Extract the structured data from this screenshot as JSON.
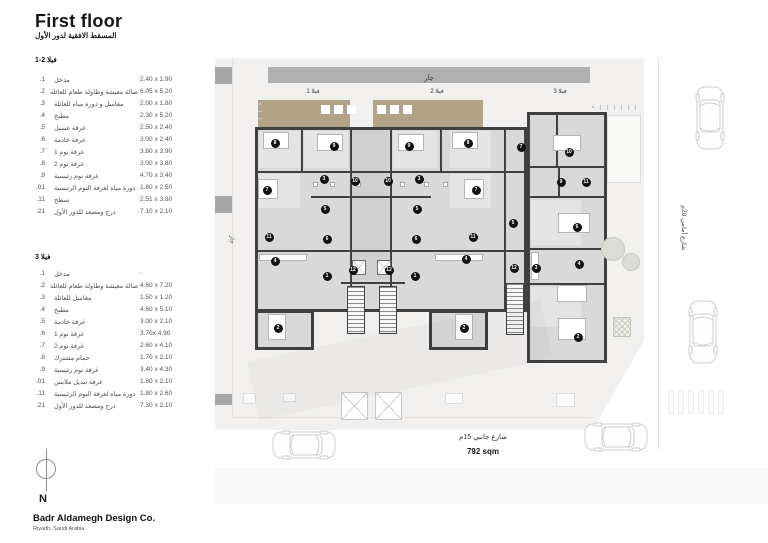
{
  "header": {
    "title": "First floor",
    "subtitle_ar": "المسقط الافقية لدور الأول"
  },
  "legends": [
    {
      "heading": "فيلا 2-1",
      "rows": [
        {
          "no": ".1",
          "name": "مدخل",
          "dim": "2.40 x 1.90"
        },
        {
          "no": ".2",
          "name": "صالة معيشة وطاولة طعام للعائلة",
          "dim": "6.05 x 5.20"
        },
        {
          "no": ".3",
          "name": "مغاسل و دورة مياه للعائلة",
          "dim": "2.00 x 1.80"
        },
        {
          "no": ".4",
          "name": "مطبخ",
          "dim": "2.30 x 5.20"
        },
        {
          "no": ".5",
          "name": "غرفة غسيل",
          "dim": "2.50 x 2.40"
        },
        {
          "no": ".6",
          "name": "غرفة خادمة",
          "dim": "3.00 x 2.40"
        },
        {
          "no": ".7",
          "name": "غرفة نوم 1",
          "dim": "3.80 x 3.90"
        },
        {
          "no": ".8",
          "name": "غرفة نوم 2",
          "dim": "3.00 x 3.80"
        },
        {
          "no": ".9",
          "name": "غرفة نوم رئيسية",
          "dim": "4.70 x 3.40"
        },
        {
          "no": ".01",
          "name": "دورة مياه لغرفة النوم الرئيسية",
          "dim": "1.80 x 2.50"
        },
        {
          "no": ".11",
          "name": "سطح",
          "dim": "2.51 x 3.80"
        },
        {
          "no": ".21",
          "name": "درج ومصعد للدور الأول",
          "dim": "7.10 x 2.10"
        }
      ]
    },
    {
      "heading": "فيلا 3",
      "rows": [
        {
          "no": ".1",
          "name": "مدخل",
          "dim": "-"
        },
        {
          "no": ".2",
          "name": "صالة معيشة وطاولة طعام للعائلة",
          "dim": "4.60 x 7.20"
        },
        {
          "no": ".3",
          "name": "مغاسل للعائلة",
          "dim": "1.50 x 1.20"
        },
        {
          "no": ".4",
          "name": "مطبخ",
          "dim": "4.60 x 5.10"
        },
        {
          "no": ".5",
          "name": "غرفة خادمة",
          "dim": "3.00 x 2.10"
        },
        {
          "no": ".6",
          "name": "غرفة نوم 1",
          "dim": "3.70x 4.90"
        },
        {
          "no": ".7",
          "name": "غرفة نوم 2",
          "dim": "2.60 x 4.10"
        },
        {
          "no": ".8",
          "name": "حمام مشترك",
          "dim": "1.70 x 2.10"
        },
        {
          "no": ".9",
          "name": "غرفة نوم رئيسية",
          "dim": "3.40 x 4.30"
        },
        {
          "no": ".01",
          "name": "غرفة تبديل ملابس",
          "dim": "1.80 x 2.10"
        },
        {
          "no": ".11",
          "name": "دورة مياه لغرفة النوم الرئيسية",
          "dim": "1.80 x 2.60"
        },
        {
          "no": ".21",
          "name": "درج ومصعد للدور الأول",
          "dim": "7.30 x 2.10"
        }
      ]
    }
  ],
  "plan": {
    "neighbor_top": "جار",
    "neighbor_left": "جار",
    "villas": [
      "فيلا 1",
      "فيلا 2",
      "فيلا 3"
    ],
    "street_side": "شارع جانبي 15م",
    "street_front": "شارع أمامي 20م",
    "area_label": "792 sqm",
    "badges": {
      "villa1": [
        {
          "n": "8",
          "x": 275,
          "y": 143
        },
        {
          "n": "9",
          "x": 334,
          "y": 146
        },
        {
          "n": "3",
          "x": 324,
          "y": 179
        },
        {
          "n": "10",
          "x": 355,
          "y": 181
        },
        {
          "n": "7",
          "x": 267,
          "y": 190
        },
        {
          "n": "5",
          "x": 325,
          "y": 209
        },
        {
          "n": "11",
          "x": 269,
          "y": 237
        },
        {
          "n": "6",
          "x": 327,
          "y": 239
        },
        {
          "n": "4",
          "x": 275,
          "y": 261
        },
        {
          "n": "12",
          "x": 353,
          "y": 270
        },
        {
          "n": "1",
          "x": 327,
          "y": 276
        },
        {
          "n": "2",
          "x": 278,
          "y": 328
        }
      ],
      "villa2": [
        {
          "n": "9",
          "x": 409,
          "y": 146
        },
        {
          "n": "8",
          "x": 468,
          "y": 143
        },
        {
          "n": "3",
          "x": 419,
          "y": 179
        },
        {
          "n": "10",
          "x": 388,
          "y": 181
        },
        {
          "n": "7",
          "x": 476,
          "y": 190
        },
        {
          "n": "5",
          "x": 417,
          "y": 209
        },
        {
          "n": "11",
          "x": 473,
          "y": 237
        },
        {
          "n": "6",
          "x": 416,
          "y": 239
        },
        {
          "n": "4",
          "x": 466,
          "y": 259
        },
        {
          "n": "12",
          "x": 389,
          "y": 270
        },
        {
          "n": "1",
          "x": 415,
          "y": 276
        },
        {
          "n": "2",
          "x": 464,
          "y": 328
        }
      ],
      "villa3": [
        {
          "n": "7",
          "x": 521,
          "y": 147
        },
        {
          "n": "10",
          "x": 569,
          "y": 152
        },
        {
          "n": "9",
          "x": 561,
          "y": 182
        },
        {
          "n": "11",
          "x": 586,
          "y": 182
        },
        {
          "n": "5",
          "x": 513,
          "y": 223
        },
        {
          "n": "6",
          "x": 577,
          "y": 227
        },
        {
          "n": "4",
          "x": 579,
          "y": 264
        },
        {
          "n": "12",
          "x": 514,
          "y": 268
        },
        {
          "n": "3",
          "x": 536,
          "y": 268
        },
        {
          "n": "2",
          "x": 578,
          "y": 337
        }
      ]
    }
  },
  "compass": {
    "label": "N"
  },
  "footer": {
    "company": "Badr Aldamegh Design Co.",
    "location": "Riyadh, Saudi Arabia."
  },
  "colors": {
    "roof_tan": "#b3a386",
    "neighbor_bar": "#b0b0b0",
    "wall": "#404040",
    "site": "#f1f0ee",
    "building": "#d9d9d9",
    "badge": "#111111"
  }
}
